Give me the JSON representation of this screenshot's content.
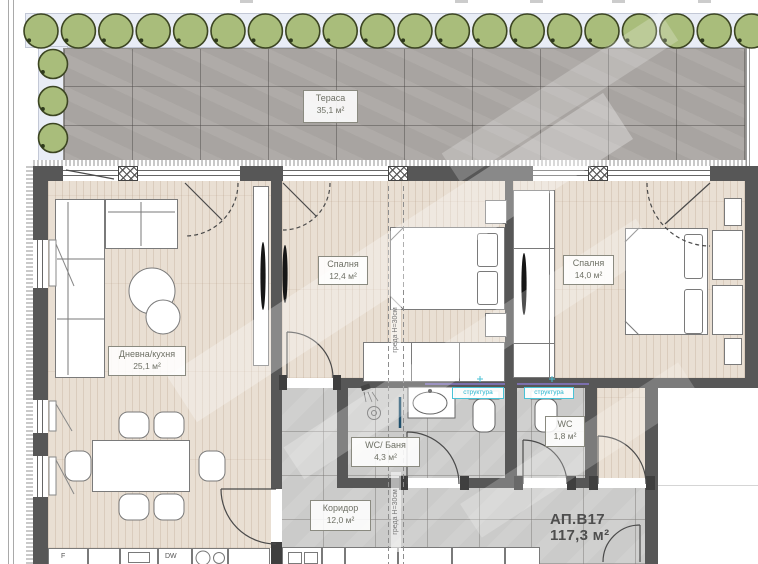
{
  "plan": {
    "apartment": {
      "id": "АП.В17",
      "area": "117,3 м²"
    },
    "rooms": {
      "terrace": {
        "name": "Тераса",
        "area": "35,1 м²"
      },
      "living": {
        "name": "Дневна/кухня",
        "area": "25,1 м²"
      },
      "bedroom1": {
        "name": "Спалня",
        "area": "12,4 м²"
      },
      "bedroom2": {
        "name": "Спалня",
        "area": "14,0 м²"
      },
      "bathroom": {
        "name": "WC/ Баня",
        "area": "4,3 м²"
      },
      "wc": {
        "name": "WC",
        "area": "1,8 м²"
      },
      "corridor": {
        "name": "Коридор",
        "area": "12,0 м²"
      }
    },
    "annotations": {
      "beam": "греда Н=30см",
      "structure": "структура"
    },
    "kitchen": {
      "fridge": "F",
      "dishwasher": "DW"
    },
    "colors": {
      "tree": "#a9bd7b",
      "tree_outline": "#3c4522",
      "wall": "#575757",
      "wood_floor": "#e9dfd3",
      "tile_floor": "#cbcbca",
      "stone_terrace": "#a8a4a1",
      "structure_accent": "#2ab5cf",
      "structure_line": "#7b6fae",
      "label_text": "#6e7065"
    },
    "trees": {
      "top_row_count": 20,
      "left_column_count": 3
    }
  }
}
